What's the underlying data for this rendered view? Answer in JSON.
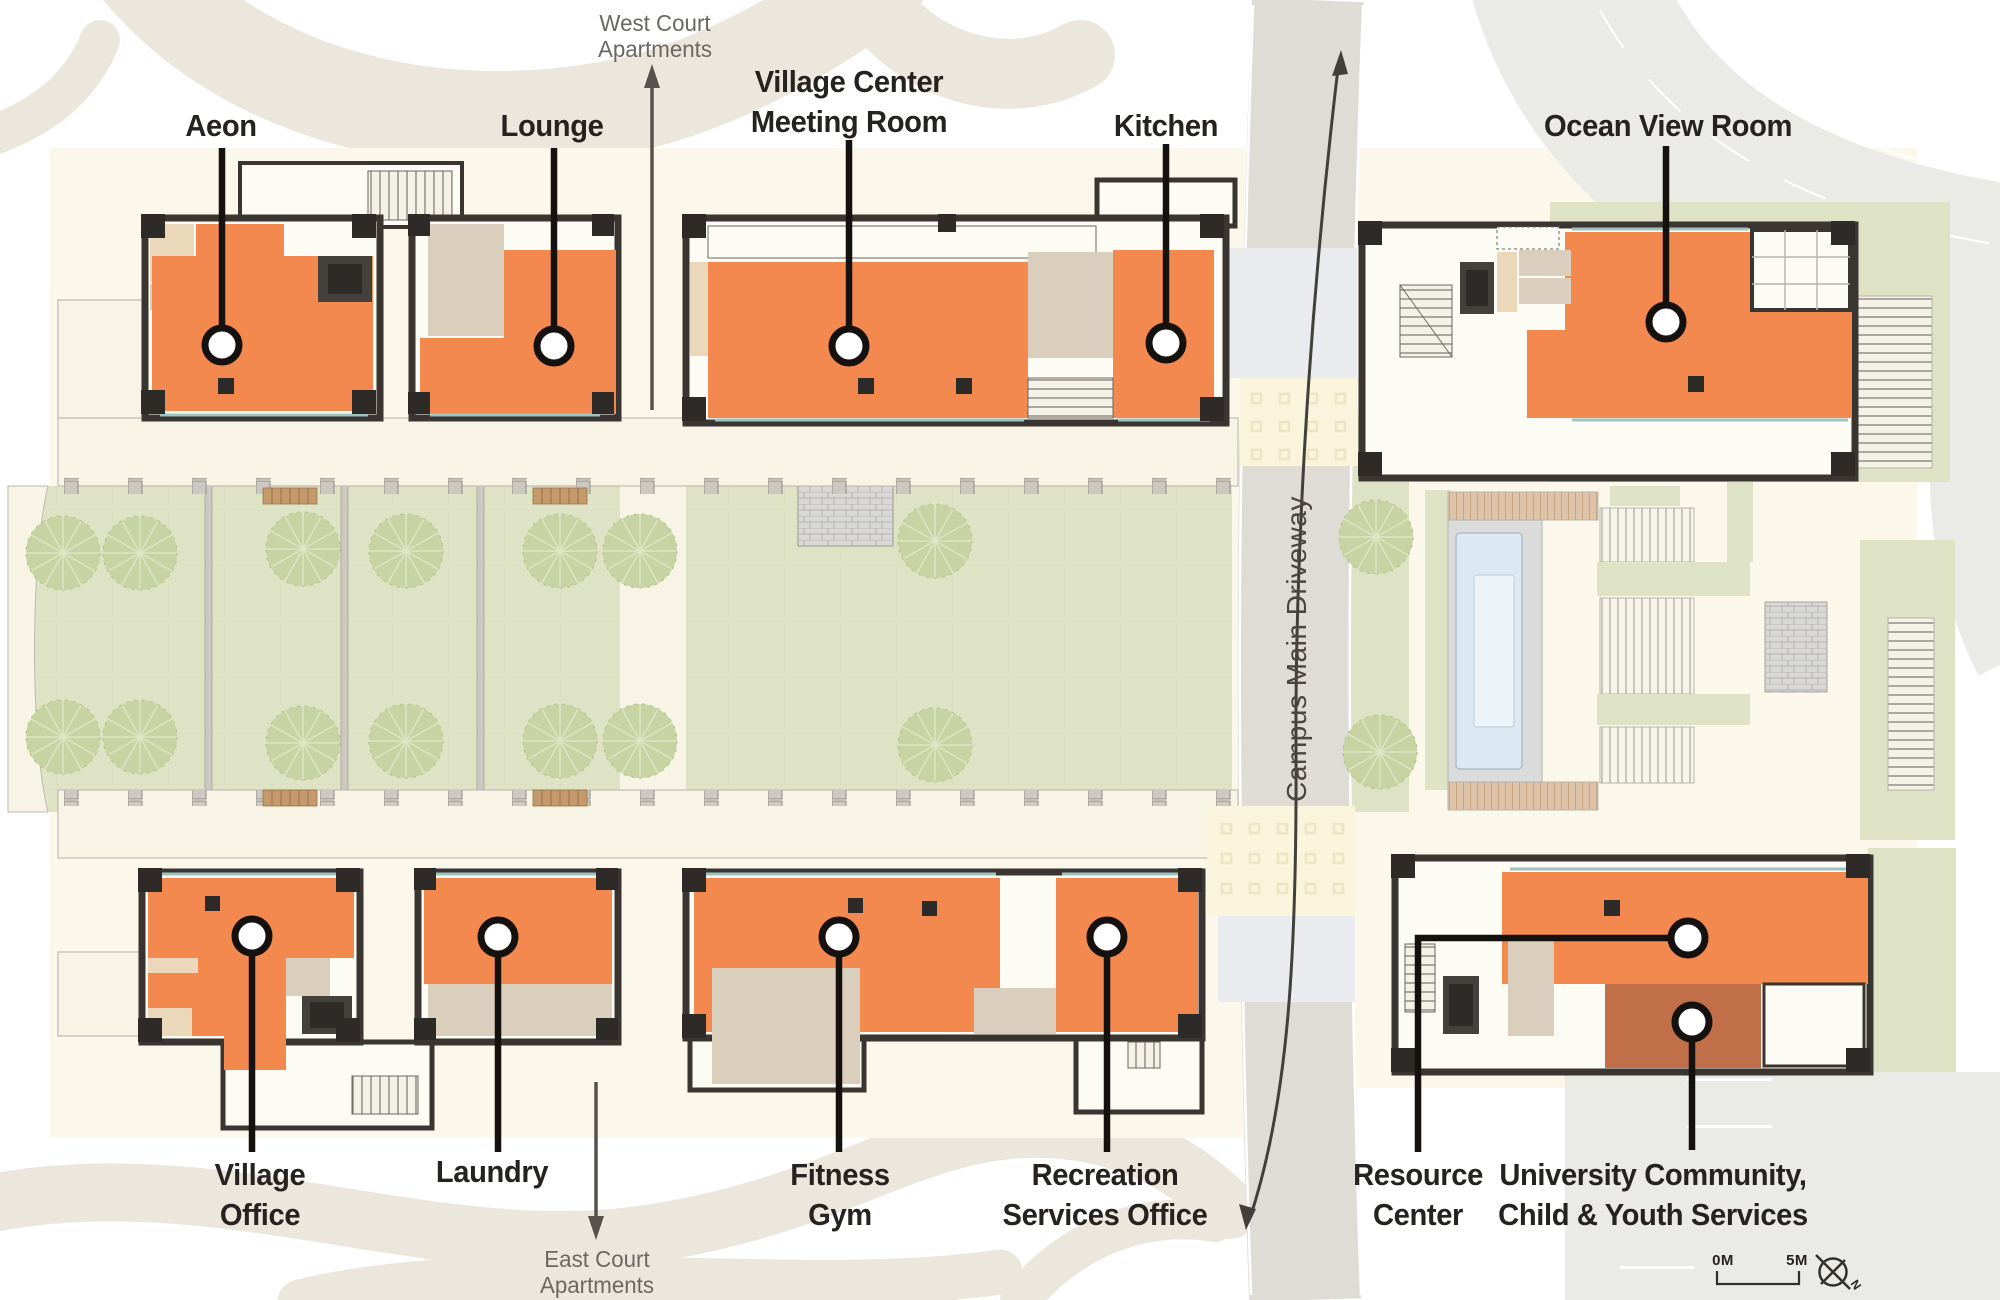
{
  "labels": {
    "rooms": [
      {
        "id": "aeon",
        "text": "Aeon"
      },
      {
        "id": "lounge",
        "text": "Lounge"
      },
      {
        "id": "meeting",
        "text": "Village Center\nMeeting Room"
      },
      {
        "id": "kitchen",
        "text": "Kitchen"
      },
      {
        "id": "ocean",
        "text": "Ocean View Room"
      },
      {
        "id": "village_office",
        "text": "Village\nOffice"
      },
      {
        "id": "laundry",
        "text": "Laundry"
      },
      {
        "id": "fitness",
        "text": "Fitness\nGym"
      },
      {
        "id": "recreation",
        "text": "Recreation\nServices Office"
      },
      {
        "id": "resource",
        "text": "Resource\nCenter"
      },
      {
        "id": "community",
        "text": "University Community,\nChild & Youth Services"
      }
    ],
    "context": {
      "west": "West Court\nApartments",
      "east": "East Court\nApartments",
      "driveway": "Campus Main Driveway"
    },
    "scale": {
      "start": "0M",
      "end": "5M",
      "north": "N"
    }
  },
  "colors": {
    "ink": "#15110F",
    "orange": "#F4894F",
    "orange_dark": "#C16F48",
    "wall": "#3A3531",
    "wall_dark": "#2E2A27",
    "cream": "#FBF8EB",
    "cream2": "#F7F4E6",
    "room": "#FCFBF4",
    "tan": "#EBD8BA",
    "bath": "#D9CFBC",
    "green": "#DFE3C5",
    "tree": "#C8D3A3",
    "driveway": "#DEDCD5",
    "road": "#EAEAE7",
    "beige": "#ECE7DC",
    "crossing": "#FAF4DC",
    "dot": "#EDE4C2",
    "pad": "#E9EBEE",
    "pool": "#DDE9F2",
    "deck": "#DFC3A8",
    "bench": "#C49A6C",
    "divider": "#CBC9C2",
    "teal": "#9EC4C2",
    "arrowgray": "#55524D"
  }
}
